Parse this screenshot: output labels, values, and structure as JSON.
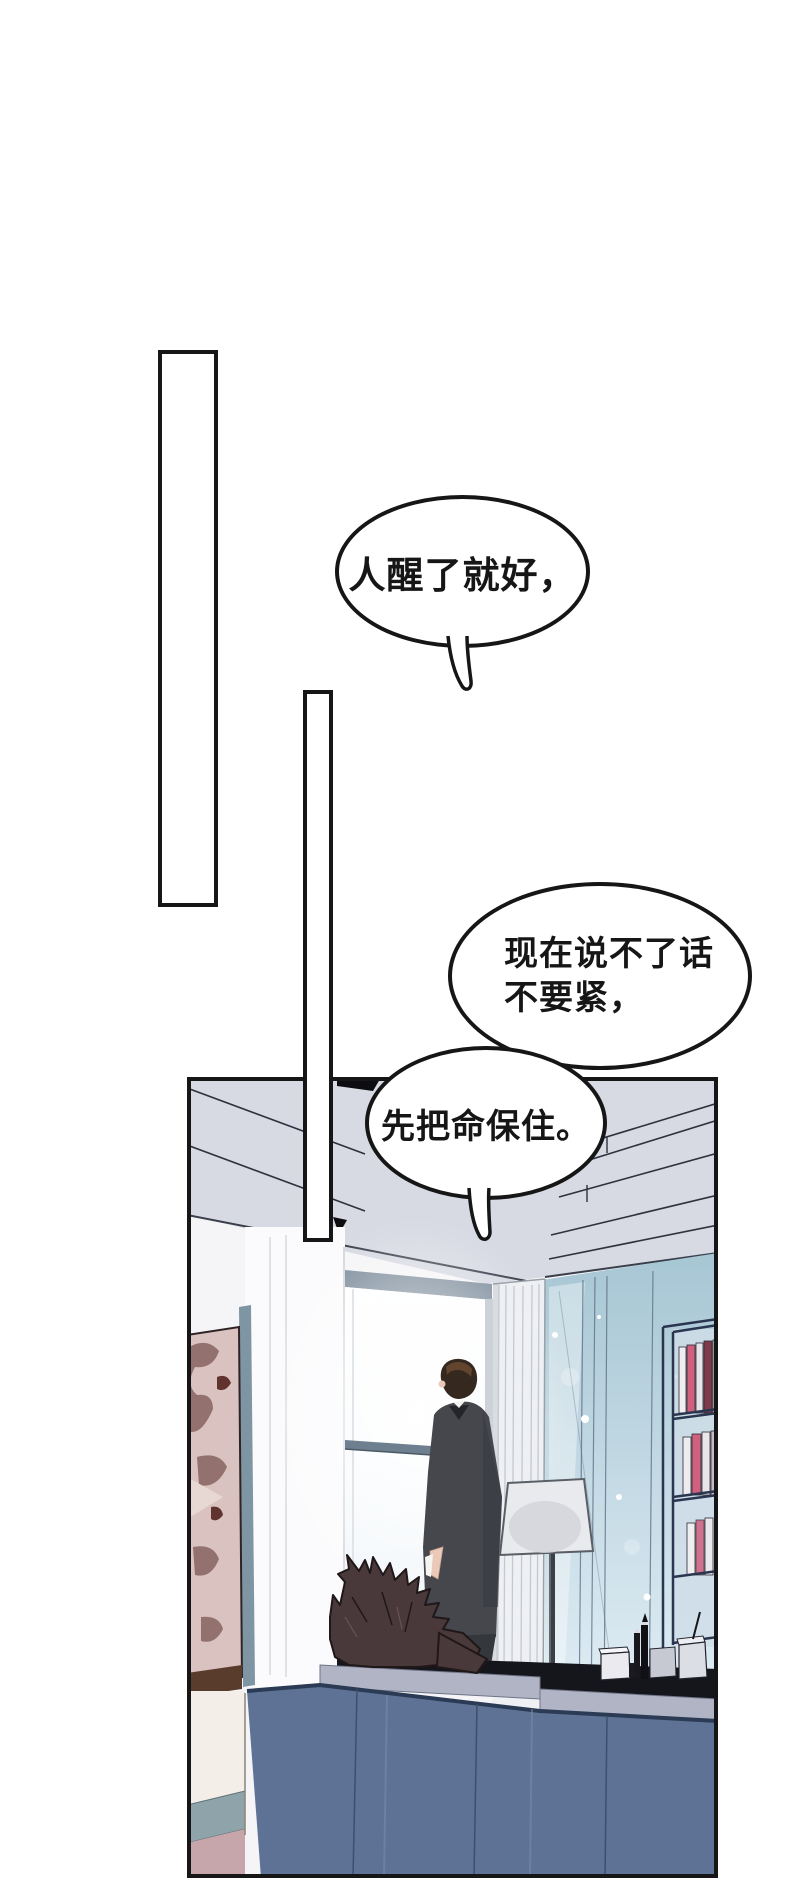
{
  "bubbles": [
    {
      "name": "speech-bubble-1",
      "lines": [
        "人醒了就好，"
      ]
    },
    {
      "name": "speech-bubble-2",
      "lines": [
        "现在说不了话",
        "不要紧，"
      ]
    },
    {
      "name": "speech-bubble-3",
      "lines": [
        "先把命保住。"
      ]
    }
  ],
  "colors": {
    "ink": "#161616",
    "ceiling": "#d7d9e3",
    "ceiling-line": "#2f323e",
    "wall": "#f5f5f7",
    "column": "#fbfbfd",
    "window-frame": "#7d8d9c",
    "mullion": "#6e7f8f",
    "glass-top": "#a7c6d4",
    "glass-bottom": "#e3eff6",
    "curtain": "#eef0f3",
    "curtain-line": "#c4c8d0",
    "suit": "#45474d",
    "trousers": "#34373c",
    "hair": "#35291f",
    "hair-shine": "#6b4a33",
    "skin": "#eac9b8",
    "lamp-shade": "#e9eaed",
    "desk": "#5d7294",
    "desk-edge": "#2b3a55",
    "desk-trim": "#b0b4c4",
    "desk-shadow": "#15161c",
    "sculpture": "#4a393b",
    "sculpture-line": "#201718",
    "painting-bg": "#d9c2bf",
    "painting-detail": "#92716f",
    "painting-dark": "#60332e",
    "frame-brown": "#5a3c2c",
    "cabinet": "#f3eee8",
    "baseboard": "#8fa3ab",
    "floor": "#c7a6ab",
    "book-pink": "#d1607e",
    "book-maroon": "#7e3a4a",
    "shelf-navy": "#2a3550",
    "glass-line": "#5f7186",
    "slate-strip": "#7e95a4"
  }
}
